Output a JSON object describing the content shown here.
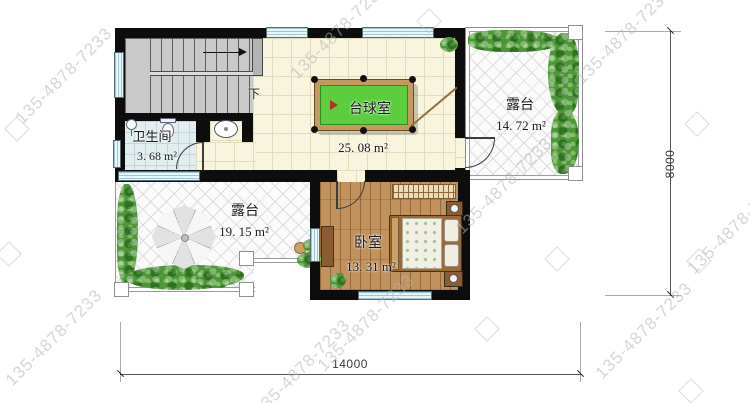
{
  "plan": {
    "rooms": {
      "billiard": {
        "label": "台球室",
        "area": "25. 08 m²"
      },
      "terrace_top": {
        "label": "露台",
        "area": "14. 72 m²"
      },
      "terrace_bottom": {
        "label": "露台",
        "area": "19. 15 m²"
      },
      "bathroom": {
        "label": "卫生间",
        "area": "3. 68 m²"
      },
      "bedroom": {
        "label": "卧室",
        "area": "13. 31 m²"
      }
    },
    "stairs": {
      "down_label": "下"
    },
    "dimensions": {
      "bottom": "14000",
      "right": "8000"
    }
  },
  "watermark": {
    "text": "135-4878-7233"
  },
  "colors": {
    "wall": "#0d0d0d",
    "pool_felt": "#5bcd3e",
    "pool_rail": "#c59a62",
    "wood_floor": "#c2925e",
    "tile_floor": "#f8f4de",
    "bath_floor": "#e2edef",
    "terrace_floor": "#fbfbfb",
    "greenery": "#4e9639",
    "window": "#e8f5fa",
    "dimension_line": "#555555",
    "watermark": "#b5b5b5"
  }
}
